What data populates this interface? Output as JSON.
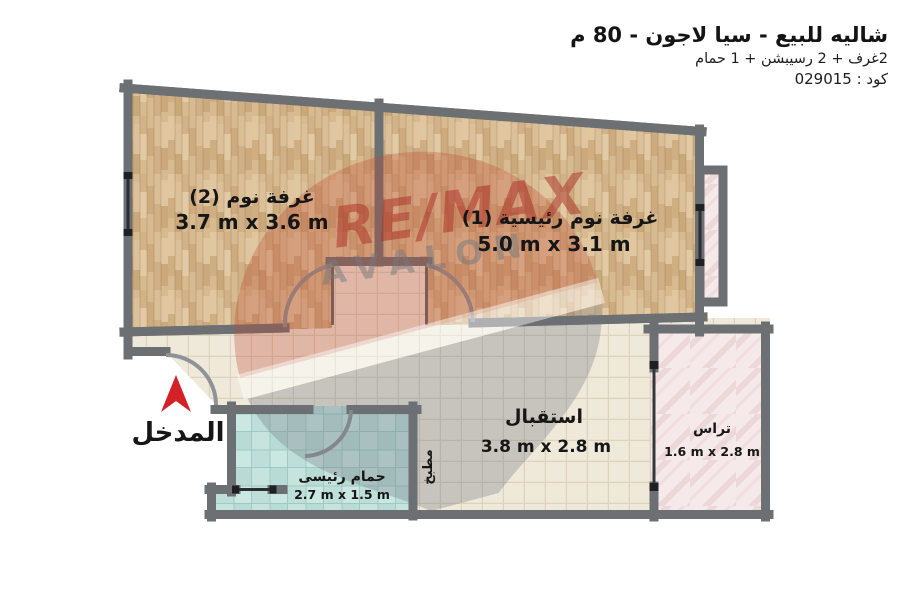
{
  "header": {
    "title": "شاليه للبيع - سيا لاجون - 80 م",
    "subtitle": "2غرف + 2 رسيبشن + 1 حمام",
    "code": "كود : 029015"
  },
  "rooms": {
    "bedroom2": {
      "name": "غرفة نوم (2)",
      "dims": "3.7 m x 3.6 m"
    },
    "bedroom1": {
      "name": "غرفة نوم رئيسية (1)",
      "dims": "5.0 m x 3.1 m"
    },
    "reception": {
      "name": "استقبال",
      "dims": "3.8 m x 2.8 m"
    },
    "terrace": {
      "name": "تراس",
      "dims": "1.6 m x 2.8 m"
    },
    "bathroom": {
      "name": "حمام رئيسى",
      "dims": "2.7 m x 1.5 m"
    },
    "kitchen": {
      "name": "مطبخ"
    }
  },
  "entrance": {
    "label": "المدخل"
  },
  "watermark": {
    "brand": "RE/MAX",
    "agency": "AVALON"
  },
  "colors": {
    "wall": "#9a9c9f",
    "wood_floor": "#d7ba90",
    "tile_floor": "#efe9da",
    "bath_floor": "#c6e3de",
    "terrace_floor": "#f6e9e9",
    "entrance_arrow": "#d42127",
    "watermark_red": "#b23228",
    "watermark_gray": "#8a8d90",
    "window_symbol": "#2b2d30"
  }
}
